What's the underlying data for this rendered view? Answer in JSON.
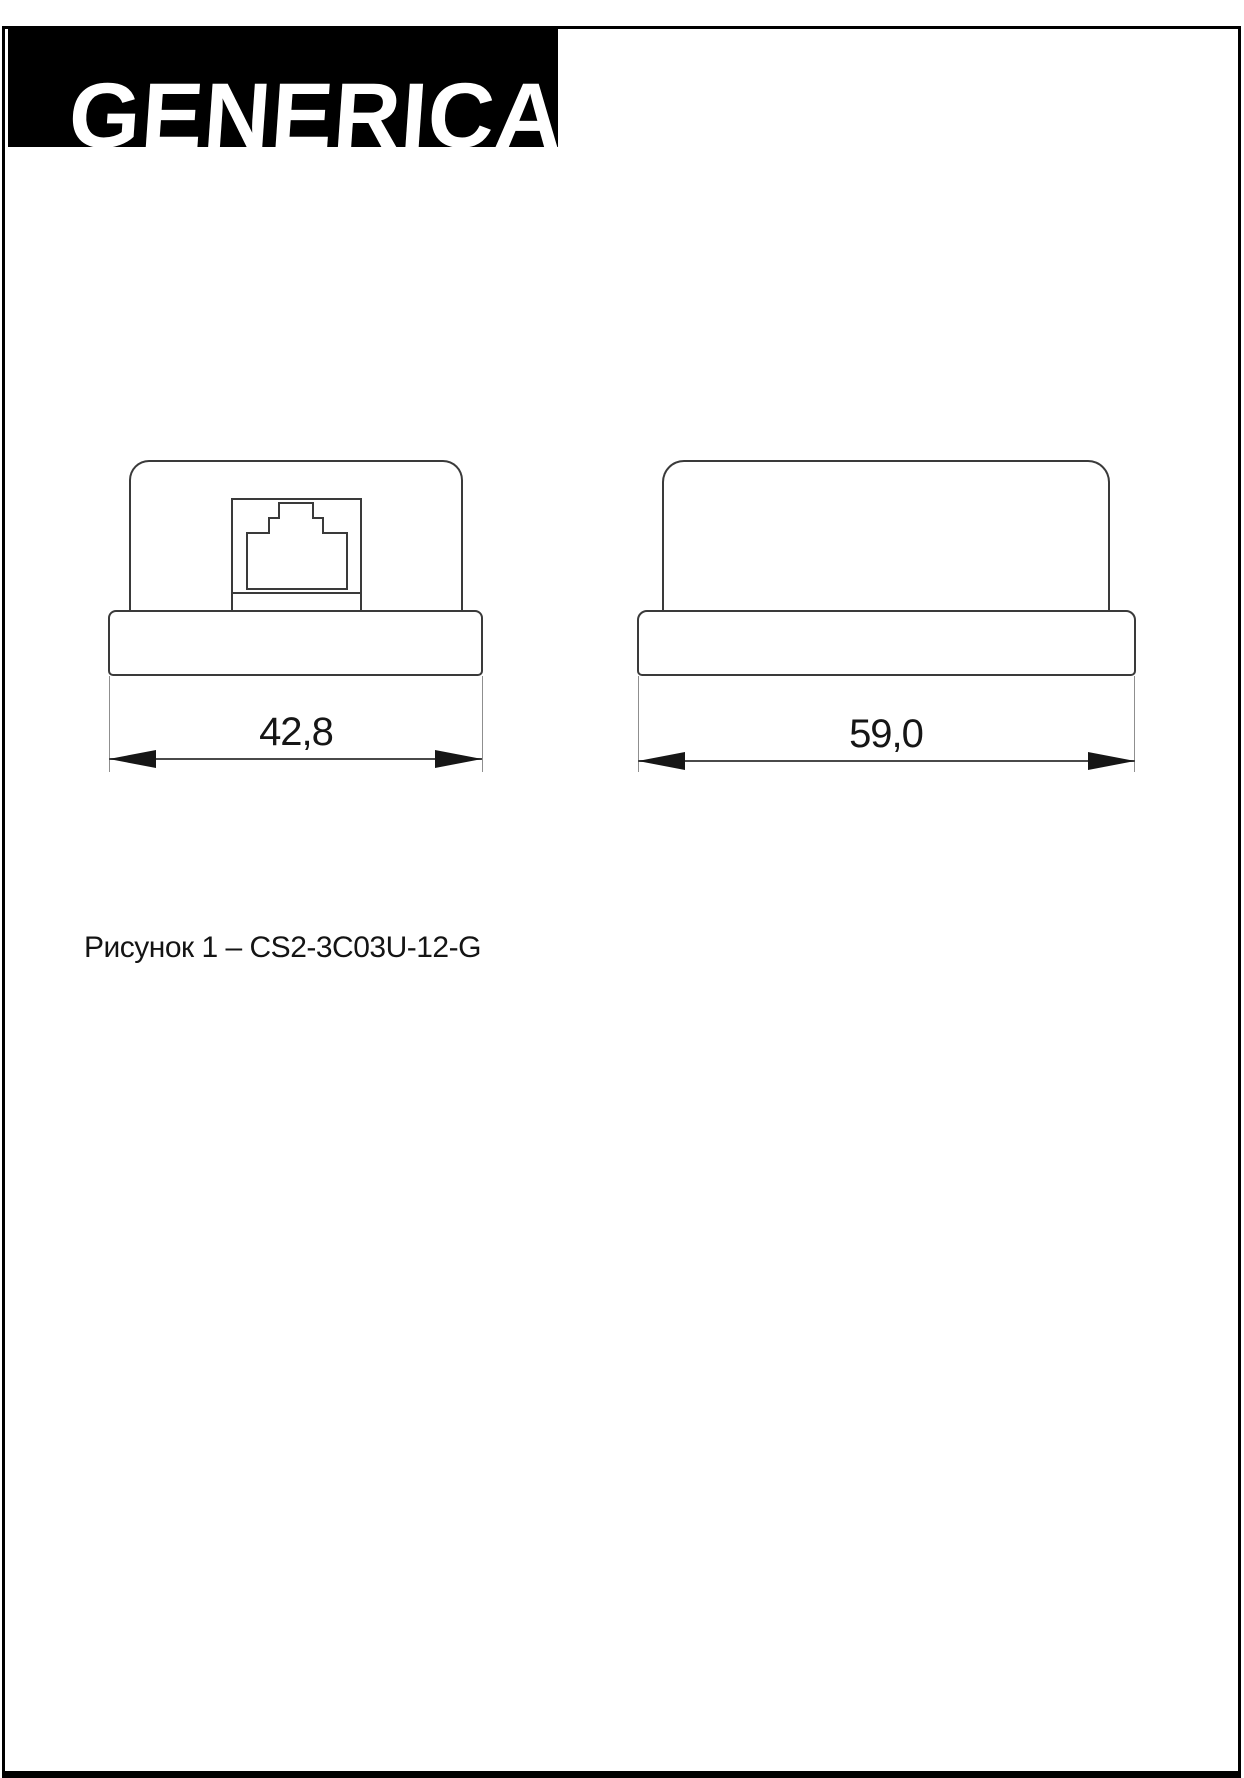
{
  "brand": {
    "logo_text": "GENERICA"
  },
  "drawing": {
    "front_view": {
      "description": "front view with RJ45 socket",
      "width_dimension": "42,8"
    },
    "side_view": {
      "description": "side view",
      "width_dimension": "59,0"
    }
  },
  "caption": {
    "text": "Рисунок 1 – CS2-3C03U-12-G"
  },
  "colors": {
    "logo_background": "#000000",
    "logo_text": "#ffffff",
    "outline": "#3a3a3a",
    "dimension_line": "#4a4a4a",
    "arrow": "#161616",
    "page_background": "#ffffff"
  }
}
